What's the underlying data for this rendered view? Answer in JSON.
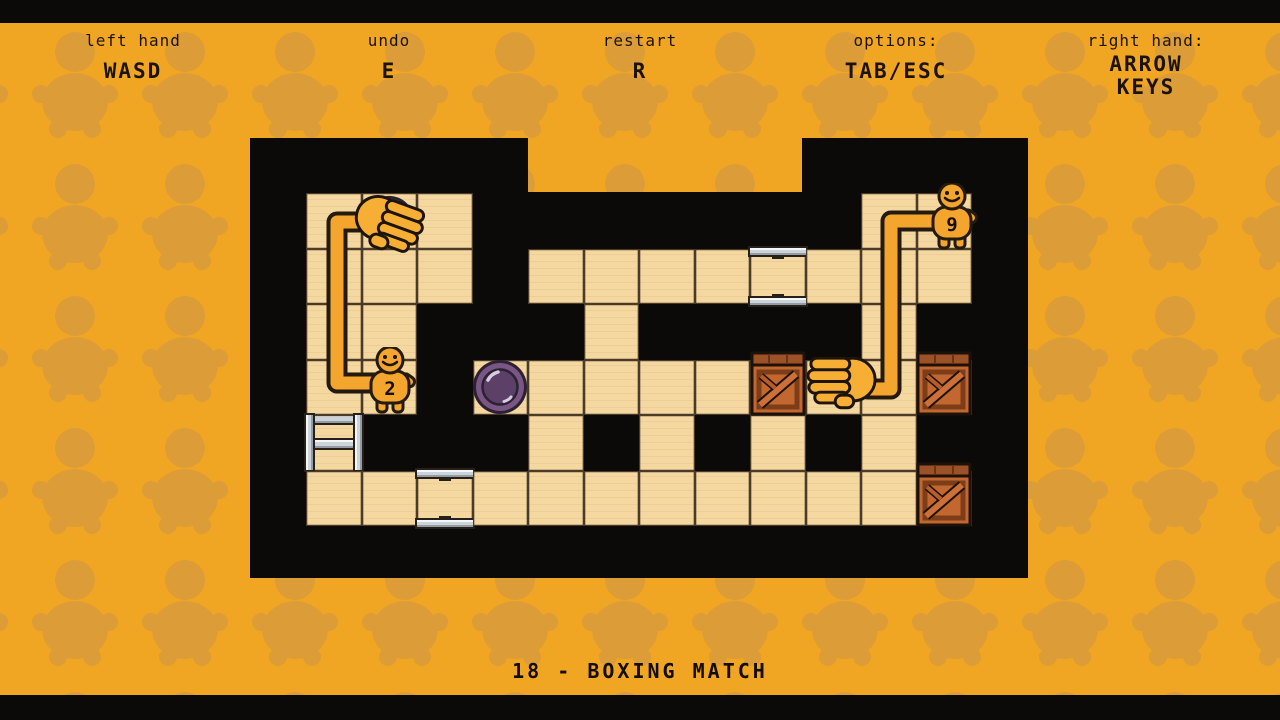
{
  "header": {
    "items": [
      {
        "label": "left hand",
        "value": "WASD"
      },
      {
        "label": "undo",
        "value": "E"
      },
      {
        "label": "restart",
        "value": "R"
      },
      {
        "label": "options:",
        "value": "TAB/ESC"
      },
      {
        "label": "right hand:",
        "value": "ARROW KEYS"
      }
    ]
  },
  "level": {
    "title": "18 - BOXING MATCH"
  },
  "board": {
    "rows": [
      "FFFWWWWWWWFF",
      "FFFWFFFFBFFF",
      "FFWWWFWWWWFW",
      "FFWFFFFFFFFF",
      "LWWWFWFWFWFW",
      "FFBFFFFFFFFF"
    ],
    "legend": {
      "F": "floor",
      "W": "void",
      "B": "socket-plate",
      "L": "ladder"
    }
  },
  "characters": [
    {
      "number": "2",
      "cell": "col1-row3"
    },
    {
      "number": "9",
      "cell": "col11-row0"
    }
  ],
  "objects": {
    "purple_discs": [
      {
        "cell": "col1-row0"
      },
      {
        "cell": "col3-row3"
      }
    ],
    "crates": [
      {
        "cell": "col8-row3"
      },
      {
        "cell": "col11-row3"
      },
      {
        "cell": "col11-row5"
      }
    ],
    "hands": [
      {
        "side": "left",
        "cell": "col1-row0"
      },
      {
        "side": "right",
        "cell": "col9-row3"
      }
    ]
  },
  "colors": {
    "background": "#F1A623",
    "pattern": "#DC9C37",
    "floor": "#F5D7A0",
    "void": "#0B0A08",
    "disc": "#7A5685",
    "crate": "#C2672F",
    "metal": "#CCD4DA",
    "arm": "#F3A52D"
  }
}
